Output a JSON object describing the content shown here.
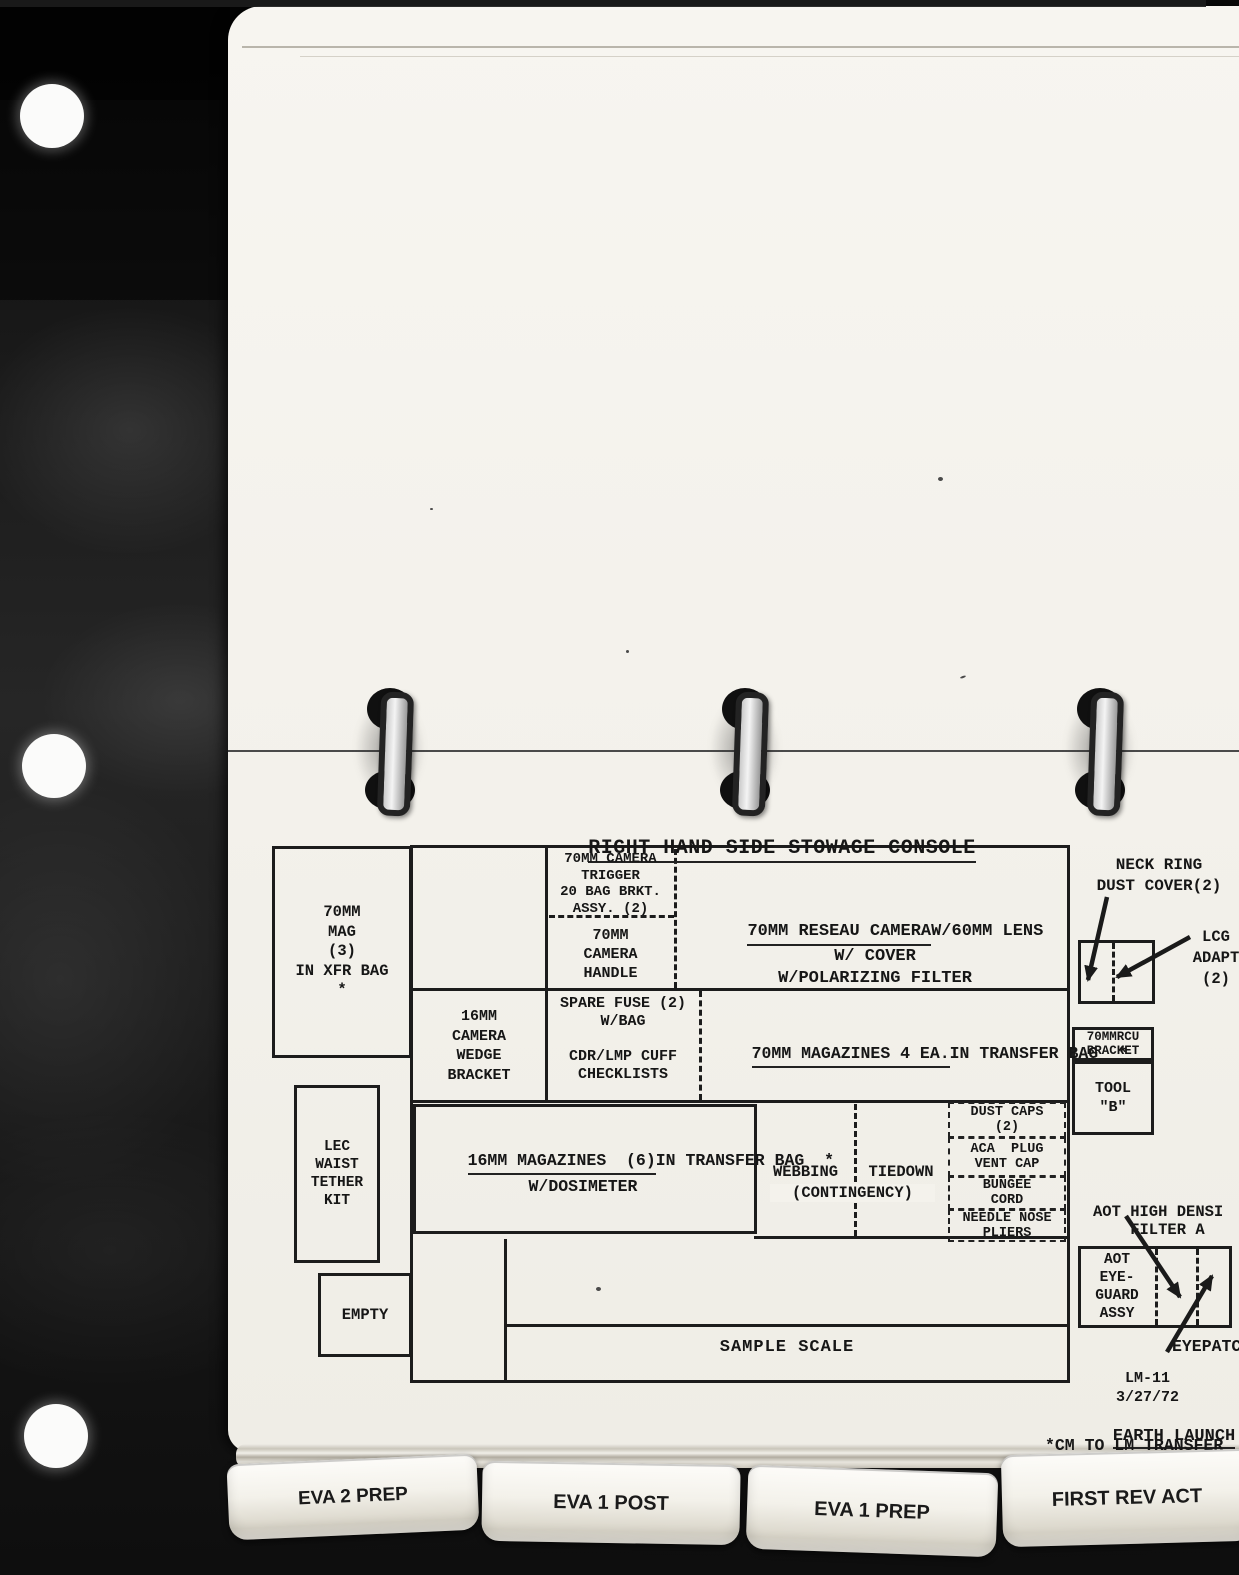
{
  "title": "RIGHT HAND SIDE STOWAGE CONSOLE",
  "console": {
    "mag70": "70MM\nMAG\n(3)\nIN XFR BAG\n*",
    "trigger": "70MM CAMERA\nTRIGGER\n20 BAG BRKT.\nASSY. (2)",
    "handle": "70MM\nCAMERA\nHANDLE",
    "reseau": {
      "line1": "70MM RESEAU CAMERA",
      "rest": "W/60MM LENS\nW/ COVER\nW/POLARIZING FILTER"
    },
    "wedge": "16MM\nCAMERA\nWEDGE\nBRACKET",
    "fuse": "SPARE FUSE (2)\nW/BAG",
    "checklists": "CDR/LMP CUFF\nCHECKLISTS",
    "mags70": {
      "line1": "70MM MAGAZINES 4 EA.",
      "line2": "IN TRANSFER BAG  *"
    },
    "lec": "LEC\nWAIST\nTETHER\nKIT",
    "mags16": {
      "line1": "16MM MAGAZINES  (6)",
      "rest": "IN TRANSFER BAG  *\nW/DOSIMETER"
    },
    "webbing": "WEBBING",
    "tiedown": "TIEDOWN",
    "contingency": "(CONTINGENCY)",
    "dust_stack": [
      "DUST CAPS\n(2)",
      "ACA  PLUG\nVENT CAP",
      "BUNGEE\nCORD",
      "NEEDLE NOSE\nPLIERS"
    ],
    "empty": "EMPTY",
    "sample_scale": "SAMPLE SCALE"
  },
  "right_side": {
    "neck_ring": "NECK RING\nDUST COVER(2)",
    "lcg": "LCG\nADAPT\n(2)",
    "rcu": "70MMRCU\nBRACKET",
    "tool_b": "TOOL\n\"B\"",
    "aot_filter": "AOT HIGH DENSI\n    FILTER A",
    "aot_eyeguard": "AOT\nEYE-\nGUARD\nASSY",
    "eyepatch": "EYEPATC",
    "lm_id": "LM-11\n3/27/72",
    "earth_launch": "EARTH LAUNCH",
    "transfer_note": "*CM TO LM TRANSFER"
  },
  "tabs": [
    {
      "label": "EVA 2 PREP"
    },
    {
      "label": "EVA 1 POST"
    },
    {
      "label": "EVA 1 PREP"
    },
    {
      "label": "FIRST REV ACT"
    }
  ],
  "colors": {
    "page": "#f5f3ee",
    "ink": "#1a1a1a",
    "scanner_bg": "#151515"
  }
}
